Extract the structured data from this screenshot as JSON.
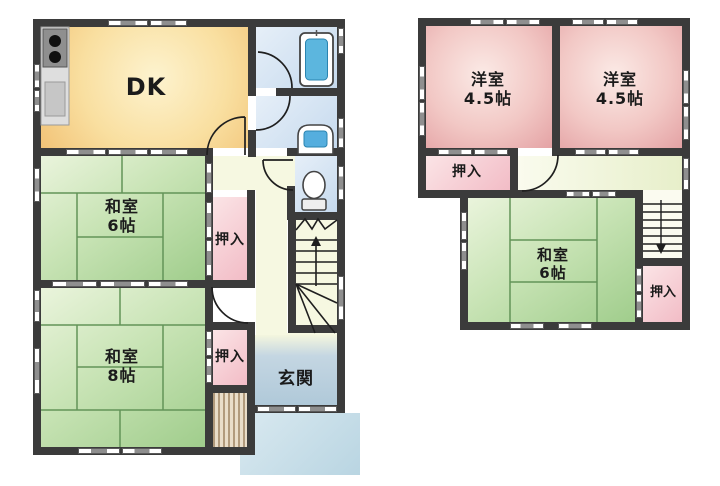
{
  "title": "2-story house floor plan",
  "floors": {
    "first": {
      "dk": "DK",
      "washitsu6": {
        "name": "和室",
        "size": "6帖"
      },
      "washitsu8": {
        "name": "和室",
        "size": "8帖"
      },
      "oshiire_a": "押入",
      "oshiire_b": "押入",
      "genkan": "玄関"
    },
    "second": {
      "yoshitsu_left": {
        "name": "洋室",
        "size": "4.5帖"
      },
      "yoshitsu_right": {
        "name": "洋室",
        "size": "4.5帖"
      },
      "washitsu6": {
        "name": "和室",
        "size": "6帖"
      },
      "oshiire_a": "押入",
      "oshiire_b": "押入"
    }
  },
  "colors": {
    "wall": "#3b3b3b",
    "dk": "#f9dfa0",
    "tatami": "#b8dba4",
    "tatami_line": "#639458",
    "closet_pink": "#f2bcc6",
    "western_pink": "#f2c8c5",
    "bath_blue": "#d3e2f1",
    "hall_cream": "#f6f8e1",
    "genkan_blue": "#b0c9d9",
    "porch_blue": "#c9dfe9",
    "fixture_blue": "#55aede",
    "text": "#1b1b1b"
  }
}
